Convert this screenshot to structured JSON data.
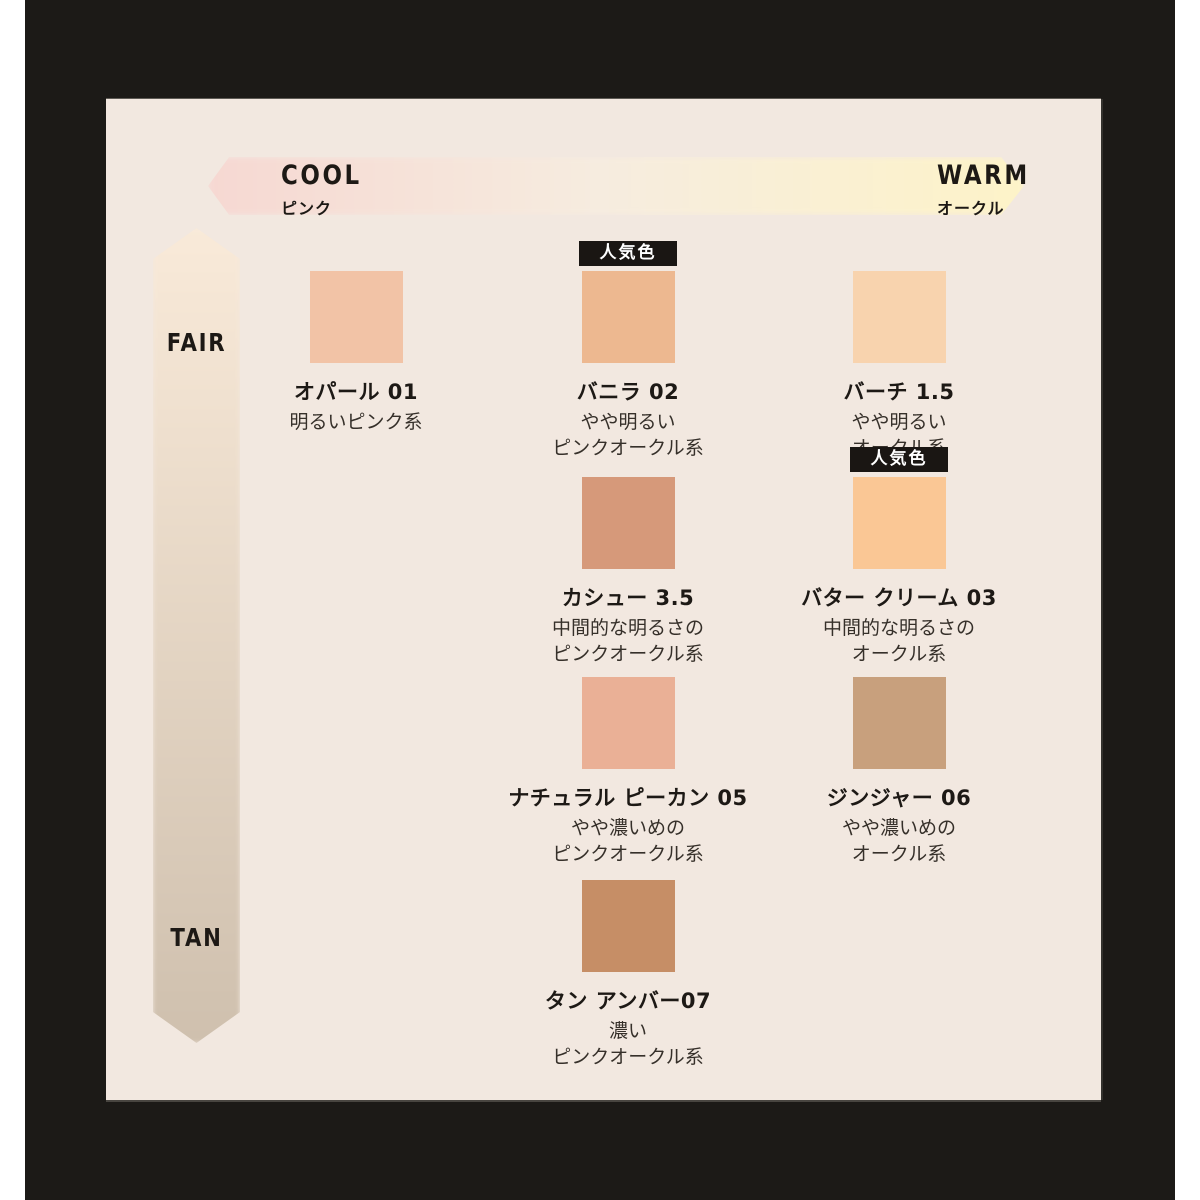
{
  "axes": {
    "horizontal": {
      "left_label": "COOL",
      "left_sub": "ピンク",
      "right_label": "WARM",
      "right_sub": "オークル"
    },
    "vertical": {
      "top_label": "FAIR",
      "bottom_label": "TAN"
    }
  },
  "badge_label": "人気色",
  "shades": [
    {
      "id": "opal-01",
      "name": "オパール 01",
      "desc": [
        "明るいピンク系"
      ],
      "color": "#f2c3a6",
      "popular": false,
      "row": 1,
      "col": 1
    },
    {
      "id": "vanilla-02",
      "name": "バニラ 02",
      "desc": [
        "やや明るい",
        "ピンクオークル系"
      ],
      "color": "#edb890",
      "popular": true,
      "row": 1,
      "col": 2
    },
    {
      "id": "birch-1.5",
      "name": "バーチ 1.5",
      "desc": [
        "やや明るい",
        "オークル系"
      ],
      "color": "#f8d3ae",
      "popular": false,
      "row": 1,
      "col": 3
    },
    {
      "id": "cashew-3.5",
      "name": "カシュー 3.5",
      "desc": [
        "中間的な明るさの",
        "ピンクオークル系"
      ],
      "color": "#d6997a",
      "popular": false,
      "row": 2,
      "col": 2
    },
    {
      "id": "butter-cream-03",
      "name": "バター クリーム 03",
      "desc": [
        "中間的な明るさの",
        "オークル系"
      ],
      "color": "#fac795",
      "popular": true,
      "row": 2,
      "col": 3
    },
    {
      "id": "natural-pecan-05",
      "name": "ナチュラル ピーカン 05",
      "desc": [
        "やや濃いめの",
        "ピンクオークル系"
      ],
      "color": "#eab096",
      "popular": false,
      "row": 3,
      "col": 2
    },
    {
      "id": "ginger-06",
      "name": "ジンジャー 06",
      "desc": [
        "やや濃いめの",
        "オークル系"
      ],
      "color": "#c8a07d",
      "popular": false,
      "row": 3,
      "col": 3
    },
    {
      "id": "tan-amber-07",
      "name": "タン アンバー07",
      "desc": [
        "濃い",
        "ピンクオークル系"
      ],
      "color": "#c68e66",
      "popular": false,
      "row": 4,
      "col": 2
    }
  ],
  "colors": {
    "page_margin": "#ffffff",
    "frame": "#1c1a17",
    "panel": "#f2e8e0",
    "text": "#1d1915",
    "badge_bg": "#1a1613",
    "badge_text": "#ffffff",
    "h_arrow_gradient": [
      "#f6d8d2",
      "#f6ecdf",
      "#fdf3c8"
    ],
    "v_arrow_gradient": [
      "#f9ead9",
      "#cfc0ae"
    ]
  }
}
